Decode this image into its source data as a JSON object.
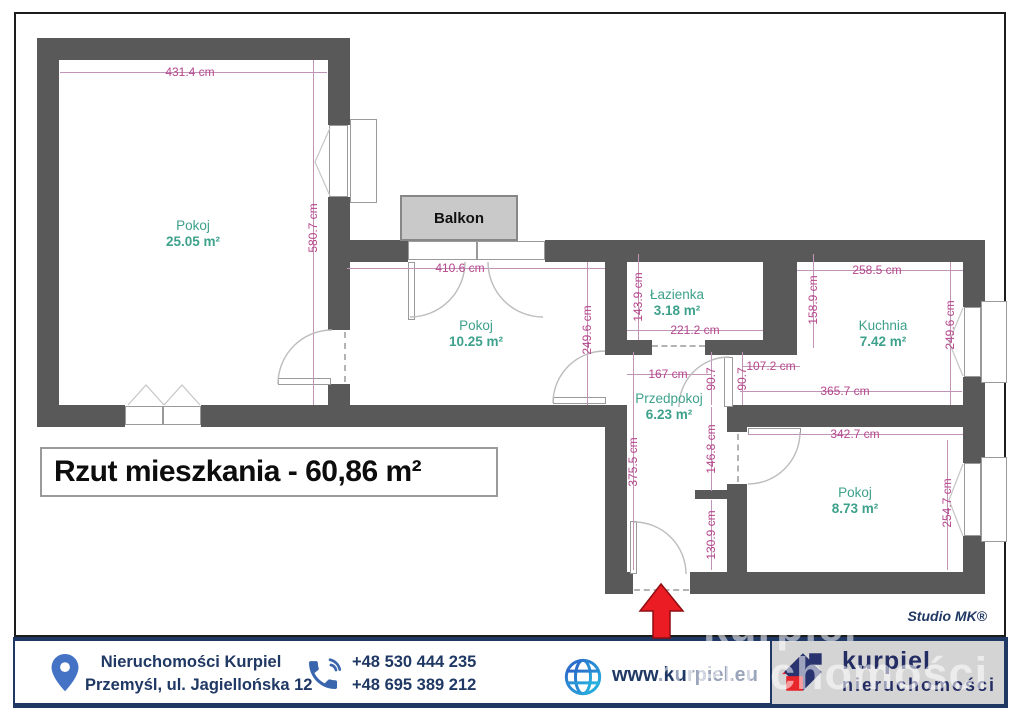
{
  "title": "Rzut mieszkania - 60,86 m²",
  "studio_credit": "Studio MK®",
  "balcony": {
    "label": "Balkon"
  },
  "rooms": {
    "room1": {
      "name": "Pokoj",
      "area": "25.05 m²"
    },
    "room2": {
      "name": "Pokoj",
      "area": "10.25 m²"
    },
    "bathroom": {
      "name": "Łazienka",
      "area": "3.18 m²"
    },
    "kitchen": {
      "name": "Kuchnia",
      "area": "7.42 m²"
    },
    "hallway": {
      "name": "Przedpokoj",
      "area": "6.23 m²"
    },
    "room3": {
      "name": "Pokoj",
      "area": "8.73 m²"
    }
  },
  "dims": {
    "room1_top": "431.4 cm",
    "room1_right": "580.7 cm",
    "room2_top": "410.6 cm",
    "room2_right": "249.6 cm",
    "bath_left": "143.9 cm",
    "bath_bottom": "221.2 cm",
    "hall_top": "167 cm",
    "kitchen_opening": "107.2 cm",
    "hall_door_a": "90.7",
    "hall_door_b": "90.7",
    "hall_left": "375.5 cm",
    "hall_mid_upper": "146.8 cm",
    "hall_mid_lower": "130.9 cm",
    "kitchen_top": "258.5 cm",
    "kitchen_left": "158.9 cm",
    "kitchen_right": "249.6 cm",
    "kitchen_bottom": "365.7 cm",
    "room3_top": "342.7 cm",
    "room3_right": "254.7 cm"
  },
  "footer": {
    "company_line1": "Nieruchomości Kurpiel",
    "company_line2": "Przemyśl, ul. Jagiellońska 12",
    "phone1": "+48 530 444 235",
    "phone2": "+48 695 389 212",
    "website_bold": "www.ku",
    "website_rest": "rpiel.eu",
    "logo_line1": "kurpiel",
    "logo_line2": "nieruchomości"
  },
  "watermark": {
    "line1": "kurpiel",
    "line2": "nieruchomości"
  },
  "colors": {
    "wall": "#595959",
    "dimension": "#b5468d",
    "room_label": "#3da18c",
    "navy": "#203864",
    "accent_blue": "#4472c4",
    "arrow_red": "#ec1c24",
    "logo_red": "#e8252a",
    "logo_navy": "#28336f"
  }
}
